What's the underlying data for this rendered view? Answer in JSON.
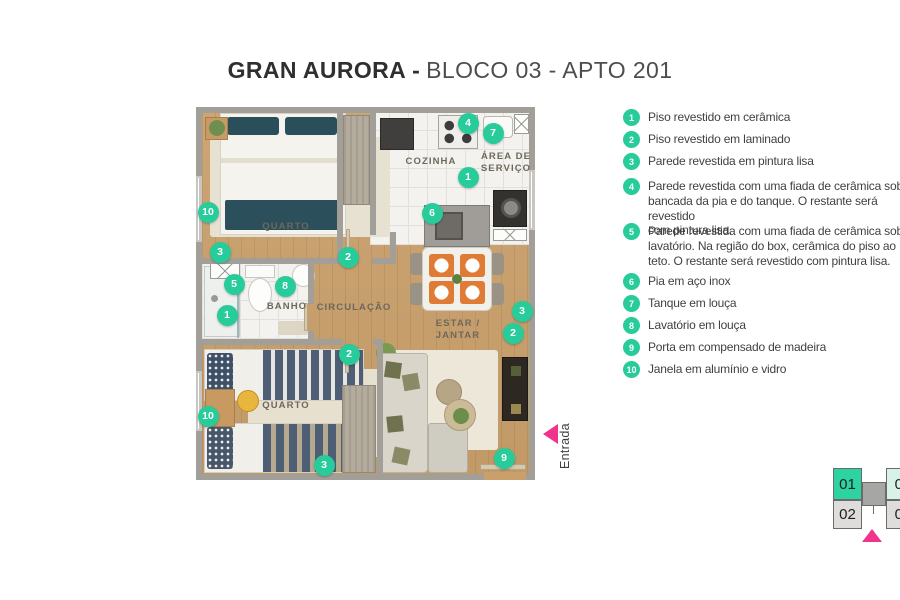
{
  "title": {
    "brand": "GRAN AURORA -",
    "unit": "BLOCO 03 - APTO 201"
  },
  "entrance": {
    "label": "Entrada"
  },
  "colors": {
    "accent_green": "#27CC9A",
    "entrance_pink": "#F0348B",
    "keyplan_active": "#2ED3A2",
    "keyplan_mint": "#D9F2E7"
  },
  "legend": {
    "items": [
      {
        "num": "1",
        "text": "Piso revestido em cerâmica"
      },
      {
        "num": "2",
        "text": "Piso revestido em laminado"
      },
      {
        "num": "3",
        "text": "Parede revestida em pintura lisa"
      },
      {
        "num": "4",
        "text": "Parede revestida com uma fiada de cerâmica sobre a\nbancada da pia e do tanque. O restante será revestido\ncom pintura lisa."
      },
      {
        "num": "5",
        "text": "Parede revestida com uma fiada de cerâmica sobre o\nlavatório. Na região do box, cerâmica do piso ao\nteto. O restante será revestido com pintura lisa."
      },
      {
        "num": "6",
        "text": "Pia em aço inox"
      },
      {
        "num": "7",
        "text": "Tanque em louça"
      },
      {
        "num": "8",
        "text": "Lavatório em louça"
      },
      {
        "num": "9",
        "text": "Porta em compensado de madeira"
      },
      {
        "num": "10",
        "text": "Janela em alumínio e vidro"
      }
    ]
  },
  "plan": {
    "room_labels": [
      {
        "text": "QUARTO",
        "x": 90,
        "y": 120
      },
      {
        "text": "COZINHA",
        "x": 235,
        "y": 55
      },
      {
        "text": "ÁREA DE\nSERVIÇO",
        "x": 310,
        "y": 56
      },
      {
        "text": "BANHO",
        "x": 91,
        "y": 200
      },
      {
        "text": "CIRCULAÇÃO",
        "x": 158,
        "y": 201
      },
      {
        "text": "ESTAR / JANTAR",
        "x": 262,
        "y": 223
      },
      {
        "text": "QUARTO",
        "x": 90,
        "y": 299
      }
    ],
    "markers": [
      {
        "num": "10",
        "x": 12,
        "y": 105
      },
      {
        "num": "3",
        "x": 24,
        "y": 145
      },
      {
        "num": "5",
        "x": 38,
        "y": 177
      },
      {
        "num": "8",
        "x": 89,
        "y": 179
      },
      {
        "num": "1",
        "x": 31,
        "y": 208
      },
      {
        "num": "2",
        "x": 152,
        "y": 150
      },
      {
        "num": "4",
        "x": 272,
        "y": 16
      },
      {
        "num": "7",
        "x": 297,
        "y": 26
      },
      {
        "num": "1",
        "x": 272,
        "y": 70
      },
      {
        "num": "6",
        "x": 236,
        "y": 106
      },
      {
        "num": "3",
        "x": 326,
        "y": 204
      },
      {
        "num": "2",
        "x": 317,
        "y": 226
      },
      {
        "num": "2",
        "x": 153,
        "y": 247
      },
      {
        "num": "10",
        "x": 12,
        "y": 309
      },
      {
        "num": "3",
        "x": 128,
        "y": 358
      },
      {
        "num": "9",
        "x": 308,
        "y": 351
      }
    ]
  },
  "keyplan": {
    "units": [
      {
        "label": "01",
        "state": "active"
      },
      {
        "label": "04",
        "state": "mint"
      },
      {
        "label": "02",
        "state": "plain"
      },
      {
        "label": "03",
        "state": "plain"
      }
    ]
  }
}
